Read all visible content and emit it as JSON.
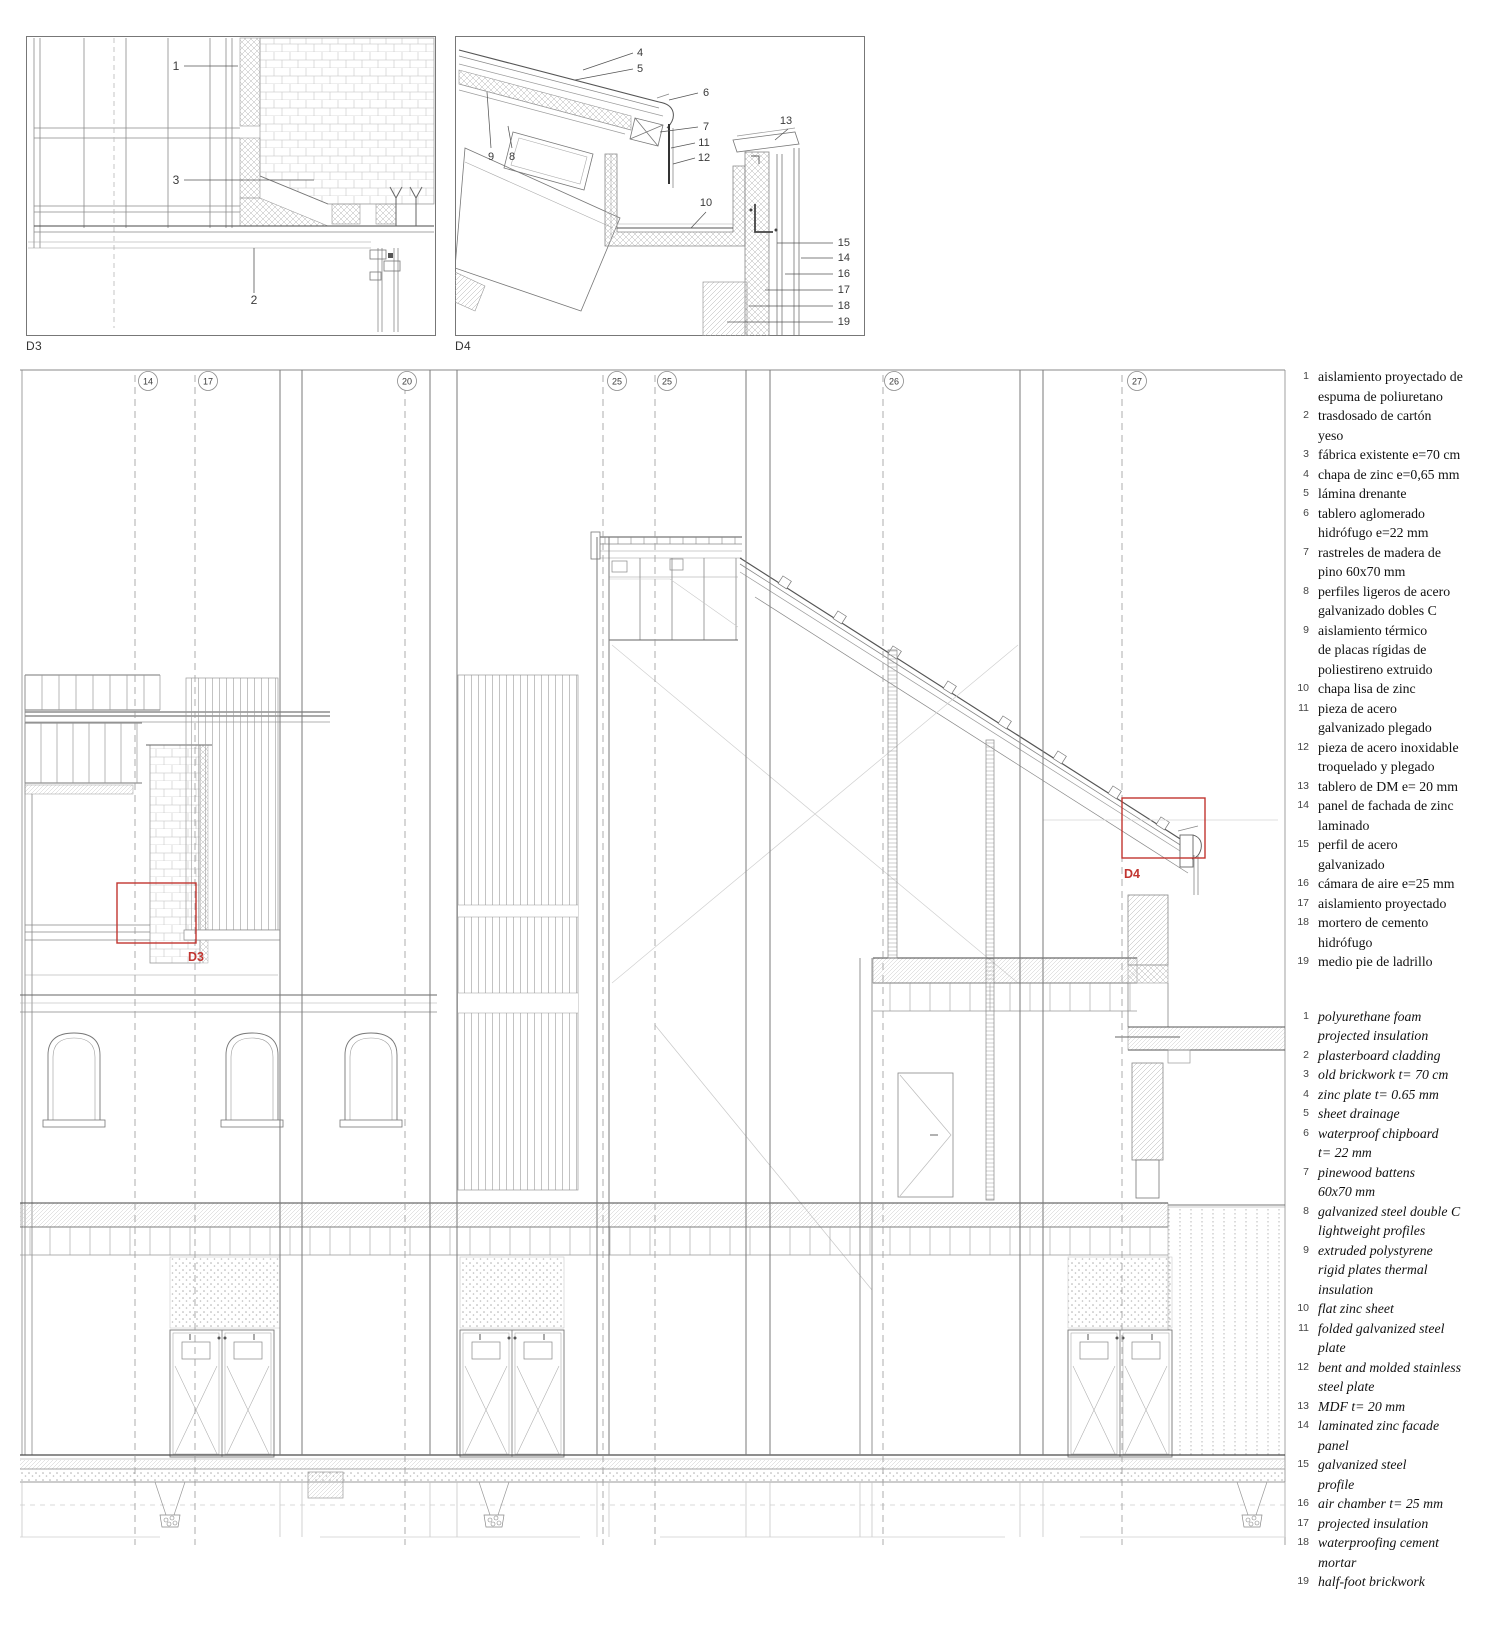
{
  "colors": {
    "red": "#c13530",
    "line": "#6e6e6e",
    "line_light": "#9c9c9c"
  },
  "details": {
    "d3": {
      "label": "D3",
      "callouts": [
        {
          "n": "1"
        },
        {
          "n": "3"
        },
        {
          "n": "2"
        }
      ]
    },
    "d4": {
      "label": "D4",
      "callouts": [
        {
          "n": "4"
        },
        {
          "n": "5"
        },
        {
          "n": "6"
        },
        {
          "n": "7"
        },
        {
          "n": "11"
        },
        {
          "n": "12"
        },
        {
          "n": "13"
        },
        {
          "n": "9"
        },
        {
          "n": "8"
        },
        {
          "n": "10"
        },
        {
          "n": "15"
        },
        {
          "n": "14"
        },
        {
          "n": "16"
        },
        {
          "n": "17"
        },
        {
          "n": "18"
        },
        {
          "n": "19"
        }
      ]
    }
  },
  "main": {
    "grid_bubbles": [
      "14",
      "17",
      "20",
      "25",
      "25",
      "26",
      "27"
    ],
    "detail_markers": [
      {
        "label": "D3"
      },
      {
        "label": "D4"
      }
    ]
  },
  "legend": {
    "spanish": [
      {
        "num": "1",
        "lines": [
          "aislamiento proyectado de",
          "espuma de poliuretano"
        ]
      },
      {
        "num": "2",
        "lines": [
          "trasdosado de cartón",
          "yeso"
        ]
      },
      {
        "num": "3",
        "lines": [
          "fábrica existente e=70 cm"
        ]
      },
      {
        "num": "4",
        "lines": [
          "chapa de zinc e=0,65 mm"
        ]
      },
      {
        "num": "5",
        "lines": [
          "lámina drenante"
        ]
      },
      {
        "num": "6",
        "lines": [
          "tablero aglomerado",
          "hidrófugo e=22 mm"
        ]
      },
      {
        "num": "7",
        "lines": [
          "rastreles de madera de",
          "pino 60x70 mm"
        ]
      },
      {
        "num": "8",
        "lines": [
          "perfiles ligeros de acero",
          "galvanizado dobles C"
        ]
      },
      {
        "num": "9",
        "lines": [
          "aislamiento térmico",
          "de placas rígidas de",
          "poliestireno extruido"
        ]
      },
      {
        "num": "10",
        "lines": [
          "chapa lisa de zinc"
        ]
      },
      {
        "num": "11",
        "lines": [
          "pieza de acero",
          "galvanizado plegado"
        ]
      },
      {
        "num": "12",
        "lines": [
          "pieza de acero inoxidable",
          "troquelado y plegado"
        ]
      },
      {
        "num": "13",
        "lines": [
          "tablero de DM e= 20 mm"
        ]
      },
      {
        "num": "14",
        "lines": [
          "panel de fachada de zinc",
          "laminado"
        ]
      },
      {
        "num": "15",
        "lines": [
          "perfil de acero",
          "galvanizado"
        ]
      },
      {
        "num": "16",
        "lines": [
          "cámara de aire e=25 mm"
        ]
      },
      {
        "num": "17",
        "lines": [
          "aislamiento proyectado"
        ]
      },
      {
        "num": "18",
        "lines": [
          "mortero de cemento",
          "hidrófugo"
        ]
      },
      {
        "num": "19",
        "lines": [
          "medio pie de ladrillo"
        ]
      }
    ],
    "english": [
      {
        "num": "1",
        "lines": [
          "polyurethane foam",
          "projected insulation"
        ]
      },
      {
        "num": "2",
        "lines": [
          "plasterboard cladding"
        ]
      },
      {
        "num": "3",
        "lines": [
          "old brickwork t= 70 cm"
        ]
      },
      {
        "num": "4",
        "lines": [
          "zinc plate t= 0.65 mm"
        ]
      },
      {
        "num": "5",
        "lines": [
          "sheet drainage"
        ]
      },
      {
        "num": "6",
        "lines": [
          "waterproof chipboard",
          "t= 22 mm"
        ]
      },
      {
        "num": "7",
        "lines": [
          "pinewood battens",
          "60x70 mm"
        ]
      },
      {
        "num": "8",
        "lines": [
          "galvanized steel double C",
          "lightweight profiles"
        ]
      },
      {
        "num": "9",
        "lines": [
          "extruded polystyrene",
          "rigid plates thermal",
          "insulation"
        ]
      },
      {
        "num": "10",
        "lines": [
          "flat zinc sheet"
        ]
      },
      {
        "num": "11",
        "lines": [
          "folded galvanized steel",
          "plate"
        ]
      },
      {
        "num": "12",
        "lines": [
          "bent and molded stainless",
          "steel plate"
        ]
      },
      {
        "num": "13",
        "lines": [
          "MDF t= 20 mm"
        ]
      },
      {
        "num": "14",
        "lines": [
          "laminated zinc facade",
          "panel"
        ]
      },
      {
        "num": "15",
        "lines": [
          "galvanized steel",
          "profile"
        ]
      },
      {
        "num": "16",
        "lines": [
          "air chamber t= 25 mm"
        ]
      },
      {
        "num": "17",
        "lines": [
          "projected insulation"
        ]
      },
      {
        "num": "18",
        "lines": [
          "waterproofing cement",
          "mortar"
        ]
      },
      {
        "num": "19",
        "lines": [
          "half-foot brickwork"
        ]
      }
    ]
  }
}
